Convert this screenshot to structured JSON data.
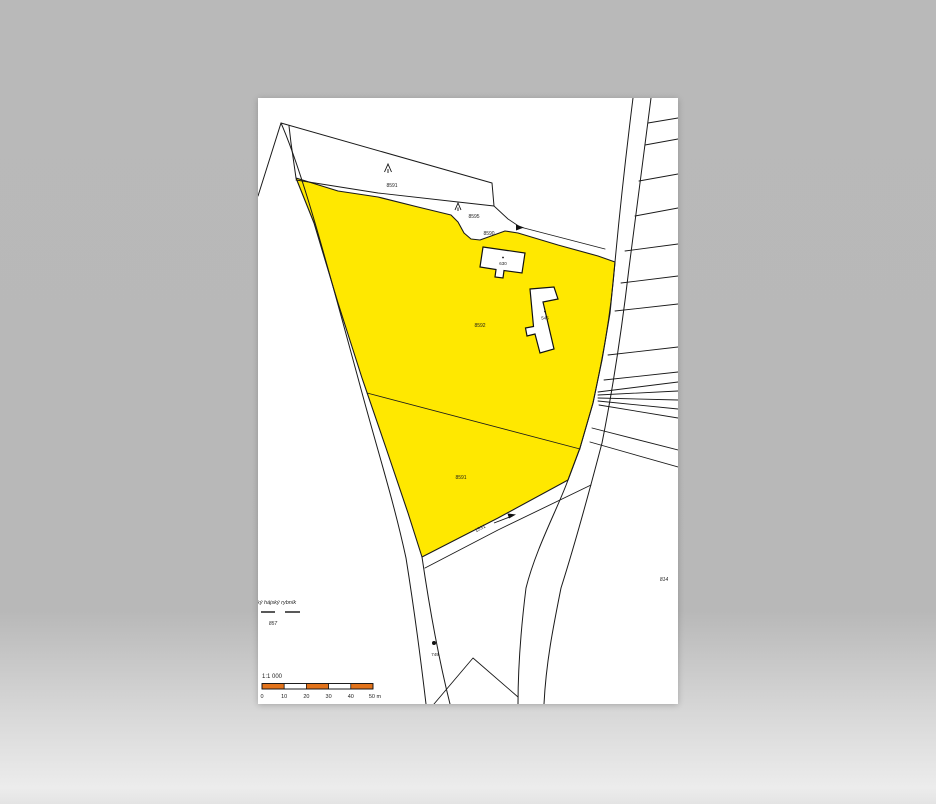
{
  "scene": {
    "background_color": "#b9b9b9",
    "paper_color": "#ffffff"
  },
  "map": {
    "highlight_color": "#ffe800",
    "line_color": "#1a1a1a",
    "parcel_labels": {
      "strip": "8591",
      "wedge_upper": "8595",
      "wedge_lower": "8590",
      "main": "8592",
      "lower": "8591",
      "path": "1531",
      "pond": "857",
      "road_marker": "749",
      "east": "814"
    },
    "building_labels": {
      "small": "630",
      "long": "545"
    },
    "pond_name": "ký hájský rybník",
    "scalebar": {
      "ratio_label": "1:1 000",
      "tick_labels": [
        "0",
        "10",
        "20",
        "30",
        "40",
        "50 m"
      ],
      "segment_colors": [
        "#e2731b",
        "#ffffff",
        "#e2731b",
        "#ffffff",
        "#e2731b"
      ],
      "bar_x": 4,
      "bar_y": 585.5,
      "segment_width": 22.2,
      "bar_height": 5.5
    }
  }
}
